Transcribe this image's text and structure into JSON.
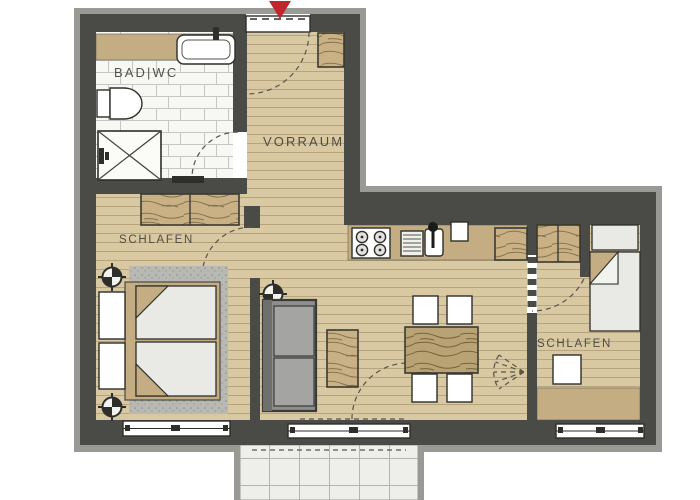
{
  "title": "Apartment floor plan",
  "labels": {
    "bathroom": "BAD|WC",
    "hallway": "VORRAUM",
    "bedroom_left": "SCHLAFEN",
    "bedroom_right": "SCHLAFEN"
  },
  "icons": {
    "entrance_arrow": "red downward arrow marking the apartment entrance",
    "crosshair_symbol": "circled cross survey/fixture symbol (3 on plan)",
    "door_swing": "dashed quarter-circle door swing arcs",
    "fan_door": "fan-shaped folding-door symbol at right bedroom wall"
  },
  "colors": {
    "wall": "#4a4a46",
    "walledge": "#9a9a95",
    "wood": "#d9c9a2",
    "woodline": "#a28c64",
    "tan": "#c4ad83",
    "tile": "#f7f7f4",
    "tileline": "#c7c7c1",
    "grain": "#c9b185",
    "grainline": "#6e5e3e",
    "rug": "#b8b8b4",
    "sofa": "#8e8e8e",
    "fixture": "#ffffff",
    "line": "#2e2e2a",
    "balcony": "#eeeeea",
    "red": "#c0272d"
  }
}
